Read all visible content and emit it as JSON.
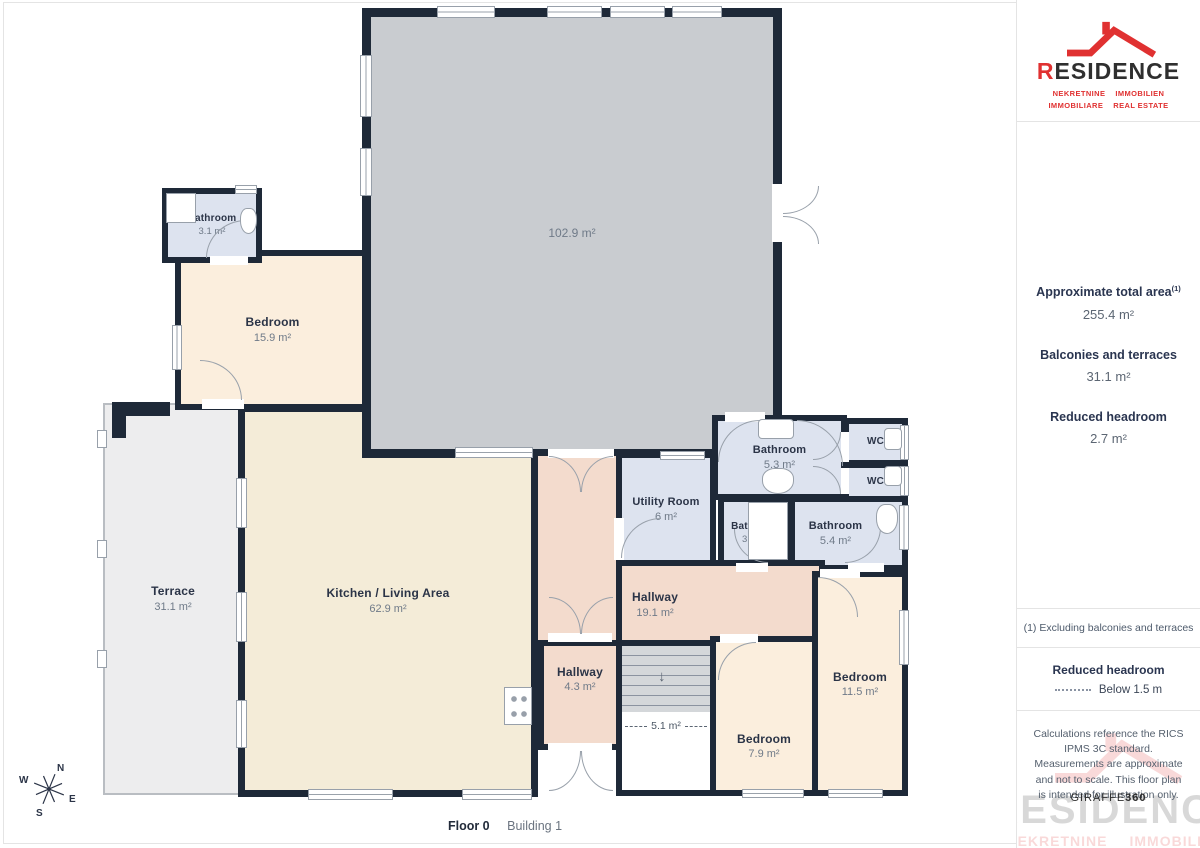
{
  "sidebar": {
    "logo": {
      "brand_first_letter": "R",
      "brand_rest": "ESIDENCE",
      "tagline_row1_left": "NEKRETNINE",
      "tagline_row1_right": "IMMOBILIEN",
      "tagline_row2_left": "IMMOBILIARE",
      "tagline_row2_right": "REAL ESTATE"
    },
    "stats": [
      {
        "label": "Approximate total area",
        "sup": "(1)",
        "value": "255.4 m²"
      },
      {
        "label": "Balconies and terraces",
        "sup": "",
        "value": "31.1 m²"
      },
      {
        "label": "Reduced headroom",
        "sup": "",
        "value": "2.7 m²"
      }
    ],
    "footnote": "(1) Excluding balconies and terraces",
    "legend": {
      "title": "Reduced headroom",
      "item": "Below 1.5 m"
    },
    "disclaimer": "Calculations reference the RICS IPMS 3C standard. Measurements are approximate and not to scale. This floor plan is intended for illustration only.",
    "brand_footer": {
      "name": "GIRAFFE",
      "suffix": "360"
    }
  },
  "footer": {
    "floor": "Floor 0",
    "building": "Building 1"
  },
  "compass": {
    "n": "N",
    "e": "E",
    "s": "S",
    "w": "W"
  },
  "rooms": [
    {
      "name": "Bathroom",
      "area": "3.1 m²"
    },
    {
      "name": "Bedroom",
      "area": "15.9 m²"
    },
    {
      "name": "",
      "area": "102.9 m²"
    },
    {
      "name": "Terrace",
      "area": "31.1 m²"
    },
    {
      "name": "Kitchen / Living Area",
      "area": "62.9 m²"
    },
    {
      "name": "Utility Room",
      "area": "6 m²"
    },
    {
      "name": "Bathroom",
      "area": "5.3 m²"
    },
    {
      "name": "WC",
      "area": ""
    },
    {
      "name": "WC",
      "area": ""
    },
    {
      "name": "Bathroom",
      "area": "3.2 m²"
    },
    {
      "name": "Bathroom",
      "area": "5.4 m²"
    },
    {
      "name": "Hallway",
      "area": "19.1 m²"
    },
    {
      "name": "Hallway",
      "area": "4.3 m²"
    },
    {
      "name": "",
      "area": "5.1 m²"
    },
    {
      "name": "Bedroom",
      "area": "7.9 m²"
    },
    {
      "name": "Bedroom",
      "area": "11.5 m²"
    }
  ],
  "colors": {
    "wall": "#1e2938",
    "accent_red": "#e03131",
    "bathroom_fill": "#dde3ef",
    "bedroom_fill": "#fbeedd",
    "kitchen_fill": "#f4ecd8",
    "hallway_fill": "#f3dbcd",
    "large_room_fill": "#c9ccd0",
    "terrace_fill": "#ededee",
    "stairs_fill": "#d4d7da"
  }
}
